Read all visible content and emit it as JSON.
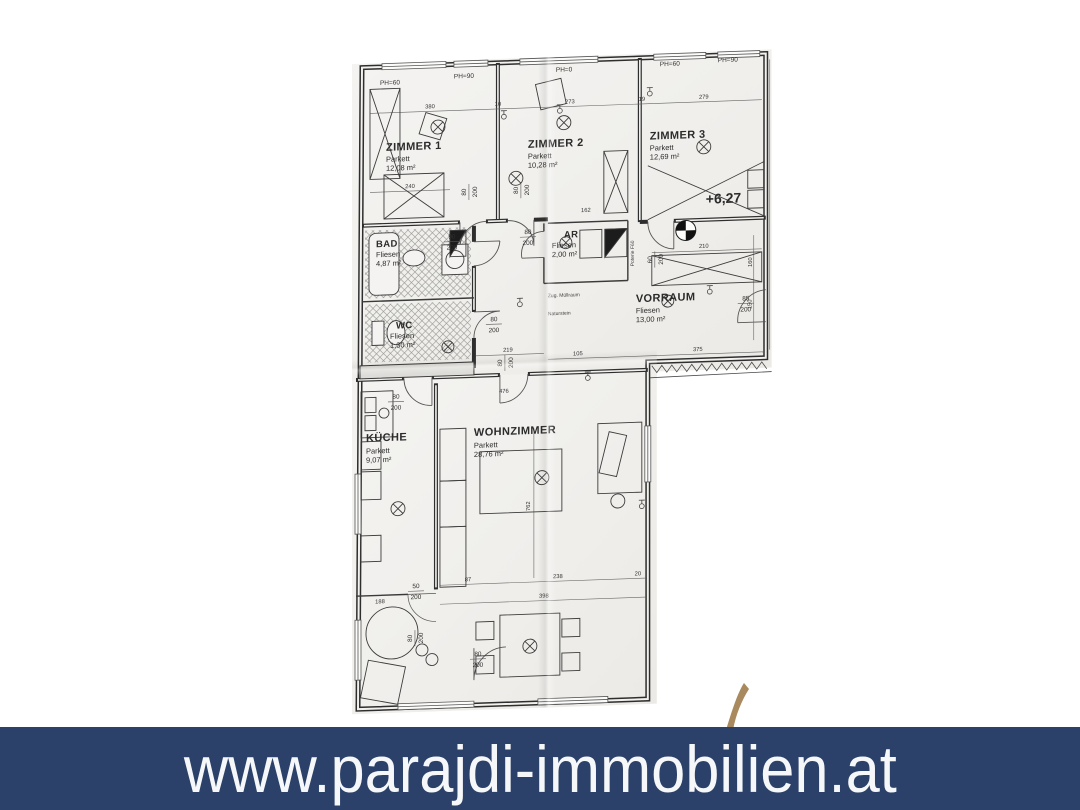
{
  "banner": {
    "text": "www.parajdi-immobilien.at",
    "bg": "#2b4169",
    "fg": "#f6f7f9"
  },
  "logo": {
    "name": "parajdi-gold-logo-fragment",
    "color": "#a98a5f"
  },
  "plan": {
    "level": "+6,27",
    "ph_labels": [
      "PH=60",
      "PH=90",
      "PH=0",
      "PH=60",
      "PH=90"
    ],
    "rooms": [
      {
        "name": "ZIMMER 1",
        "floor": "Parkett",
        "area": "12,08 m²"
      },
      {
        "name": "ZIMMER 2",
        "floor": "Parkett",
        "area": "10,28 m²"
      },
      {
        "name": "ZIMMER 3",
        "floor": "Parkett",
        "area": "12,69 m²"
      },
      {
        "name": "BAD",
        "floor": "Fliesen",
        "area": "4,87 m²"
      },
      {
        "name": "WC",
        "floor": "Fliesen",
        "area": "1,30 m²"
      },
      {
        "name": "AR",
        "floor": "Fliesen",
        "area": "2,00 m²"
      },
      {
        "name": "VORRAUM",
        "floor": "Fliesen",
        "area": "13,00 m²"
      },
      {
        "name": "KÜCHE",
        "floor": "Parkett",
        "area": "9,07 m²"
      },
      {
        "name": "WOHNZIMMER",
        "floor": "Parkett",
        "area": "28,76 m²"
      }
    ],
    "doors": [
      {
        "w": "80",
        "h": "200"
      },
      {
        "w": "80",
        "h": "200"
      },
      {
        "w": "80",
        "h": "200"
      },
      {
        "w": "90",
        "h": "200"
      },
      {
        "w": "80",
        "h": "200"
      },
      {
        "w": "60",
        "h": "200"
      },
      {
        "w": "85",
        "h": "200"
      },
      {
        "w": "80",
        "h": "200"
      },
      {
        "w": "80",
        "h": "200"
      },
      {
        "w": "50",
        "h": "200"
      },
      {
        "w": "80",
        "h": "200"
      },
      {
        "w": "80",
        "h": "200"
      }
    ],
    "dims": [
      "380",
      "273",
      "279",
      "240",
      "210",
      "162",
      "219",
      "105",
      "375",
      "87",
      "238",
      "398",
      "762",
      "188",
      "476",
      "150",
      "160",
      "20",
      "10",
      "19"
    ],
    "notes": [
      "Zug. Müllraum",
      "Naturstein",
      "Poterie F60"
    ]
  }
}
